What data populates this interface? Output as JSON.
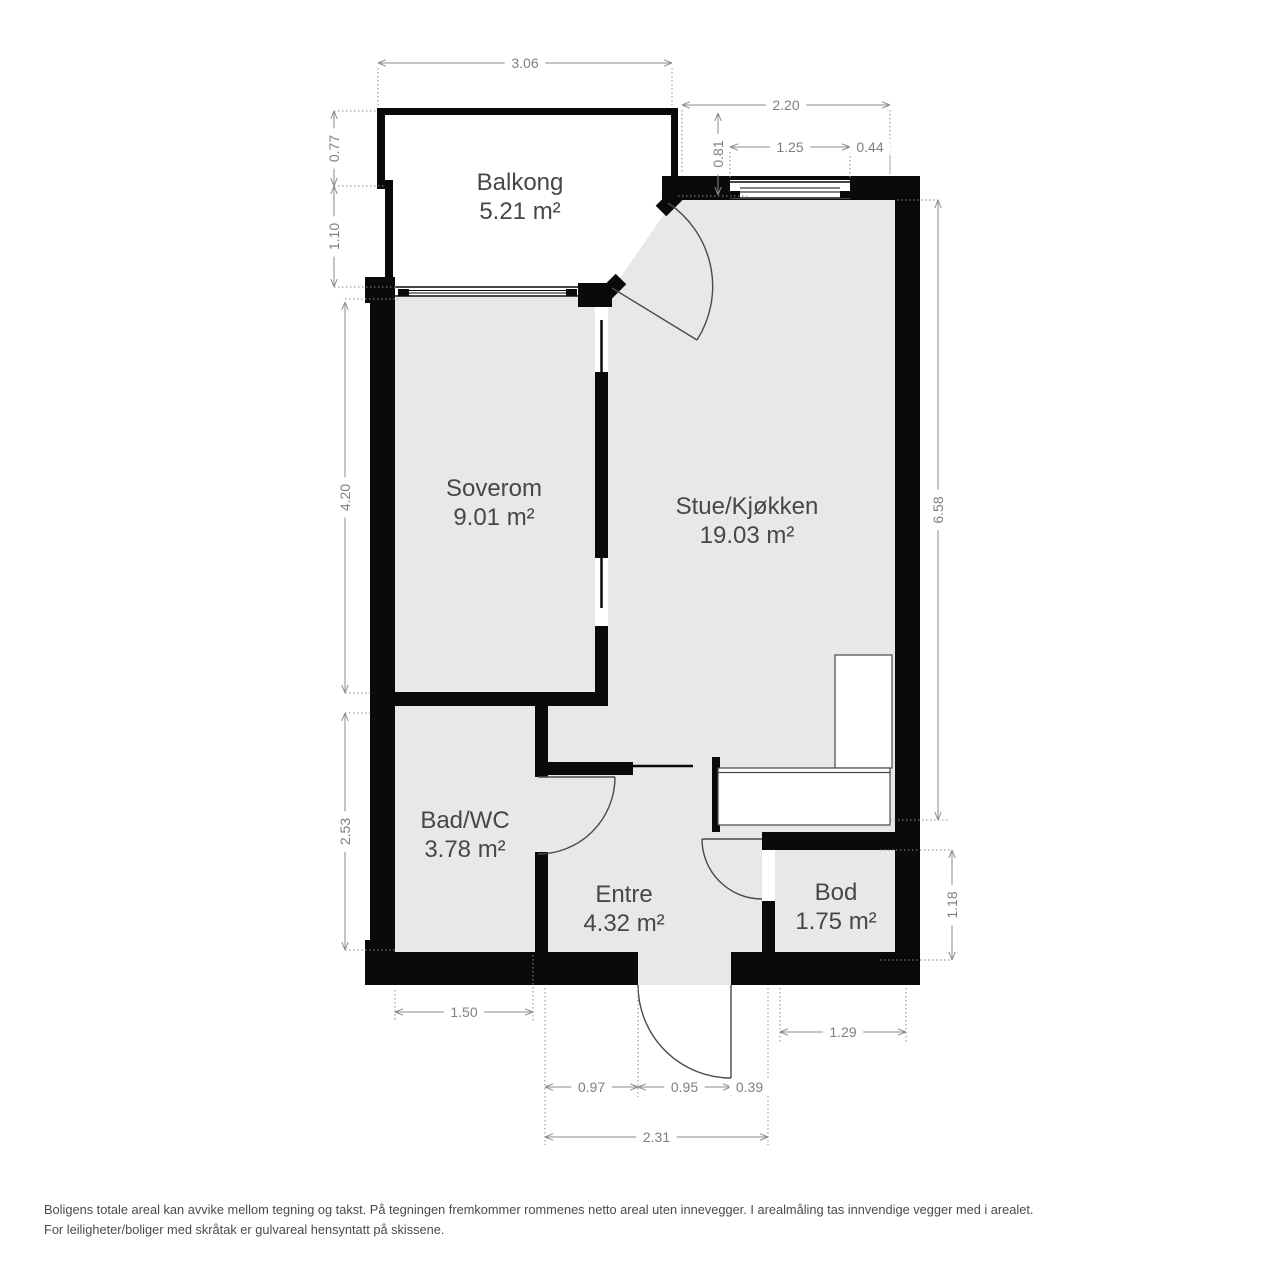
{
  "title": "Floor plan",
  "rooms": {
    "balkong": {
      "name": "Balkong",
      "area": "5.21 m²"
    },
    "soverom": {
      "name": "Soverom",
      "area": "9.01 m²"
    },
    "stue": {
      "name": "Stue/Kjøkken",
      "area": "19.03 m²"
    },
    "bad": {
      "name": "Bad/WC",
      "area": "3.78 m²"
    },
    "entre": {
      "name": "Entre",
      "area": "4.32 m²"
    },
    "bod": {
      "name": "Bod",
      "area": "1.75 m²"
    }
  },
  "dimensions": {
    "top_width": "3.06",
    "kitchen_top_width": "2.20",
    "balcony_door_drop": "0.81",
    "kitchen_window_width": "1.25",
    "kitchen_window_right": "0.44",
    "balcony_left_upper": "0.77",
    "balcony_left_lower": "1.10",
    "soverom_height": "4.20",
    "bad_height": "2.53",
    "stue_height": "6.58",
    "bod_height": "1.18",
    "bad_width": "1.50",
    "bod_width": "1.29",
    "entrance_left": "0.97",
    "entrance_door": "0.95",
    "entrance_right": "0.39",
    "entrance_total": "2.31"
  },
  "footer": {
    "line1": "Boligens totale areal kan avvike mellom tegning og takst. På tegningen fremkommer rommenes netto areal uten innevegger. I arealmåling tas innvendige vegger med i arealet.",
    "line2": "For leiligheter/boliger med skråtak er gulvareal hensyntatt på skissene."
  },
  "colors": {
    "wall": "#0a0a0a",
    "floor": "#e8e8e8",
    "dim": "#8b8b8b",
    "dim_text": "#7f7f7f",
    "label": "#474747",
    "footer": "#4a4a4a",
    "fixture_outline": "#4a4a4a"
  }
}
